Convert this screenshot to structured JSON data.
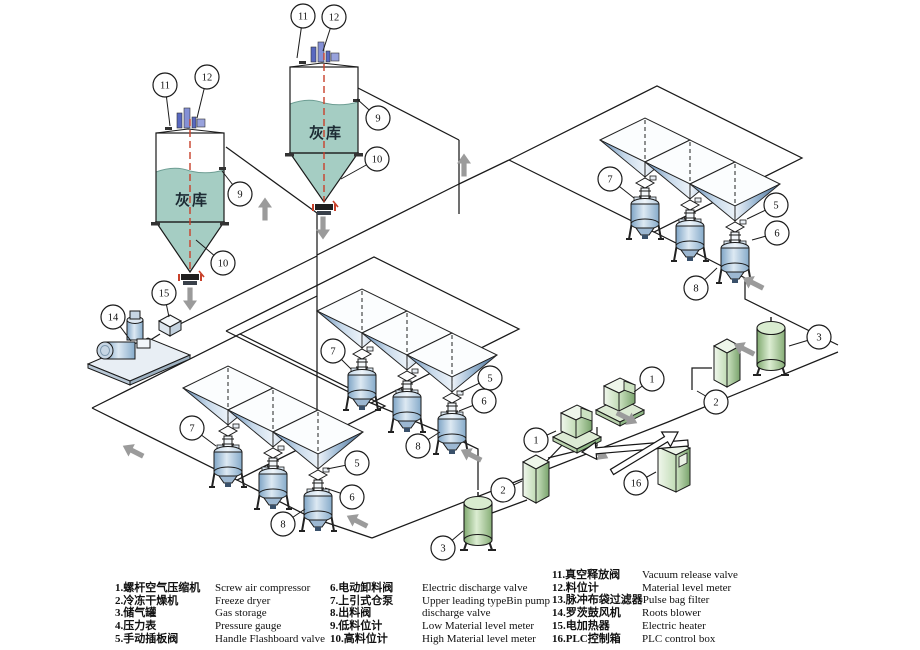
{
  "title": "Pneumatic ash conveying system diagram",
  "colors": {
    "pipe": "#1a1a1a",
    "silo_fill": "#a5cdc3",
    "silo_wave": "#6d9d93",
    "red_line": "#c8402a",
    "gray_arrow": "#9b9b9b",
    "hopper_dark": "#44698f",
    "hopper_light": "#e9f1f8",
    "green_dark": "#79a36c",
    "green_light": "#eef6ea",
    "instrument_blue": "#6375c4",
    "valve_dark": "#1f1f1f"
  },
  "silos": [
    {
      "label": "灰库",
      "x": 156,
      "y": 133,
      "w": 68,
      "h": 89,
      "tip": 272,
      "fillTop": 170,
      "labelY": 205,
      "callout_refs": [
        "11",
        "12",
        "9",
        "10"
      ]
    },
    {
      "label": "灰库",
      "x": 290,
      "y": 67,
      "w": 68,
      "h": 86,
      "tip": 202,
      "fillTop": 102,
      "labelY": 138,
      "callout_refs": [
        "11",
        "12",
        "9",
        "10"
      ]
    }
  ],
  "rows": [
    {
      "name": "hopper-row-bottom-left",
      "x": 228,
      "y": 388
    },
    {
      "name": "hopper-row-middle",
      "x": 362,
      "y": 311
    },
    {
      "name": "hopper-row-top-right",
      "x": 645,
      "y": 140
    }
  ],
  "pipes": [
    [
      [
        144,
        344
      ],
      [
        160,
        334
      ]
    ],
    [
      [
        178,
        325
      ],
      [
        317,
        256
      ]
    ],
    [
      [
        317,
        213
      ],
      [
        317,
        440
      ]
    ],
    [
      [
        226,
        147
      ],
      [
        317,
        213
      ]
    ],
    [
      [
        358,
        88
      ],
      [
        459,
        140
      ]
    ],
    [
      [
        459,
        140
      ],
      [
        459,
        214
      ]
    ],
    [
      [
        317,
        255
      ],
      [
        459,
        184
      ]
    ],
    [
      [
        459,
        184
      ],
      [
        509,
        160
      ]
    ],
    [
      [
        92,
        408
      ],
      [
        240,
        334
      ],
      [
        385,
        406
      ],
      [
        237,
        480
      ],
      [
        92,
        408
      ]
    ],
    [
      [
        226,
        331
      ],
      [
        374,
        257
      ],
      [
        519,
        329
      ],
      [
        371,
        403
      ],
      [
        226,
        331
      ]
    ],
    [
      [
        509,
        160
      ],
      [
        657,
        86
      ],
      [
        802,
        158
      ],
      [
        654,
        232
      ],
      [
        509,
        160
      ]
    ],
    [
      [
        240,
        334
      ],
      [
        317,
        296
      ]
    ],
    [
      [
        237,
        480
      ],
      [
        310,
        517
      ],
      [
        372,
        538
      ]
    ],
    [
      [
        371,
        403
      ],
      [
        455,
        438
      ],
      [
        478,
        449
      ],
      [
        478,
        490
      ]
    ],
    [
      [
        654,
        232
      ],
      [
        702,
        256
      ],
      [
        745,
        278
      ],
      [
        745,
        299
      ],
      [
        838,
        345
      ]
    ],
    [
      [
        372,
        538
      ],
      [
        668,
        422
      ],
      [
        838,
        352
      ]
    ],
    [
      [
        548,
        458
      ],
      [
        597,
        446
      ],
      [
        597,
        427
      ]
    ],
    [
      [
        527,
        500
      ],
      [
        492,
        513
      ]
    ],
    [
      [
        565,
        442
      ],
      [
        545,
        463
      ]
    ],
    [
      [
        692,
        390
      ],
      [
        692,
        368
      ],
      [
        712,
        368
      ]
    ]
  ],
  "equipment": [
    {
      "type": "blower",
      "x": 135,
      "y": 348,
      "ref": "14"
    },
    {
      "type": "heater",
      "x": 170,
      "y": 326,
      "ref": "15"
    },
    {
      "type": "compressor",
      "x": 575,
      "y": 425,
      "ref": "1"
    },
    {
      "type": "compressor",
      "x": 618,
      "y": 398,
      "ref": "1"
    },
    {
      "type": "dryer",
      "x": 536,
      "y": 482,
      "ref": "2"
    },
    {
      "type": "dryer",
      "x": 727,
      "y": 366,
      "ref": "2"
    },
    {
      "type": "tank",
      "x": 478,
      "y": 520,
      "ref": "3"
    },
    {
      "type": "tank",
      "x": 771,
      "y": 345,
      "ref": "3"
    },
    {
      "type": "plc",
      "x": 674,
      "y": 467,
      "ref": "16"
    }
  ],
  "flow_arrows": [
    {
      "x": 190,
      "y": 299,
      "dir": "down"
    },
    {
      "x": 323,
      "y": 228,
      "dir": "down"
    },
    {
      "x": 265,
      "y": 209,
      "dir": "up"
    },
    {
      "x": 464,
      "y": 165,
      "dir": "up"
    },
    {
      "x": 133,
      "y": 451,
      "dir": "upleft"
    },
    {
      "x": 357,
      "y": 521,
      "dir": "upleft"
    },
    {
      "x": 471,
      "y": 455,
      "dir": "upleft"
    },
    {
      "x": 753,
      "y": 283,
      "dir": "upleft"
    },
    {
      "x": 744,
      "y": 349,
      "dir": "upleft"
    },
    {
      "x": 598,
      "y": 453,
      "dir": "downright"
    },
    {
      "x": 627,
      "y": 418,
      "dir": "downright"
    }
  ],
  "signal_arrows": [
    {
      "x1": 688,
      "y1": 443,
      "x2": 582,
      "y2": 452
    },
    {
      "x1": 612,
      "y1": 472,
      "x2": 678,
      "y2": 432
    }
  ],
  "callouts": [
    {
      "n": "11",
      "x": 165,
      "y": 85,
      "tx": 170,
      "ty": 126
    },
    {
      "n": "12",
      "x": 207,
      "y": 77,
      "tx": 197,
      "ty": 118
    },
    {
      "n": "9",
      "x": 240,
      "y": 194,
      "tx": 222,
      "ty": 171
    },
    {
      "n": "10",
      "x": 223,
      "y": 263,
      "tx": 196,
      "ty": 240
    },
    {
      "n": "15",
      "x": 164,
      "y": 293,
      "tx": 169,
      "ty": 317
    },
    {
      "n": "14",
      "x": 113,
      "y": 317,
      "tx": 131,
      "ty": 341
    },
    {
      "n": "11",
      "x": 303,
      "y": 16,
      "tx": 297,
      "ty": 58
    },
    {
      "n": "12",
      "x": 334,
      "y": 17,
      "tx": 323,
      "ty": 51
    },
    {
      "n": "9",
      "x": 378,
      "y": 118,
      "tx": 357,
      "ty": 99
    },
    {
      "n": "10",
      "x": 377,
      "y": 159,
      "tx": 341,
      "ty": 179
    },
    {
      "n": "7",
      "x": 192,
      "y": 428,
      "tx": 216,
      "ty": 446
    },
    {
      "n": "5",
      "x": 357,
      "y": 463,
      "tx": 327,
      "ty": 469
    },
    {
      "n": "6",
      "x": 352,
      "y": 497,
      "tx": 325,
      "ty": 488
    },
    {
      "n": "8",
      "x": 283,
      "y": 524,
      "tx": 305,
      "ty": 509
    },
    {
      "n": "7",
      "x": 333,
      "y": 351,
      "tx": 351,
      "ty": 369
    },
    {
      "n": "5",
      "x": 490,
      "y": 378,
      "tx": 461,
      "ty": 392
    },
    {
      "n": "6",
      "x": 484,
      "y": 401,
      "tx": 459,
      "ty": 411
    },
    {
      "n": "8",
      "x": 418,
      "y": 446,
      "tx": 440,
      "ty": 432
    },
    {
      "n": "7",
      "x": 610,
      "y": 179,
      "tx": 634,
      "ty": 198
    },
    {
      "n": "5",
      "x": 776,
      "y": 205,
      "tx": 747,
      "ty": 219
    },
    {
      "n": "6",
      "x": 777,
      "y": 233,
      "tx": 752,
      "ty": 240
    },
    {
      "n": "8",
      "x": 696,
      "y": 288,
      "tx": 717,
      "ty": 268
    },
    {
      "n": "1",
      "x": 536,
      "y": 440,
      "tx": 556,
      "ty": 431
    },
    {
      "n": "1",
      "x": 652,
      "y": 379,
      "tx": 634,
      "ty": 392
    },
    {
      "n": "2",
      "x": 503,
      "y": 490,
      "tx": 522,
      "ty": 481
    },
    {
      "n": "2",
      "x": 716,
      "y": 402,
      "tx": 697,
      "ty": 391
    },
    {
      "n": "3",
      "x": 443,
      "y": 548,
      "tx": 463,
      "ty": 531
    },
    {
      "n": "3",
      "x": 819,
      "y": 337,
      "tx": 789,
      "ty": 346
    },
    {
      "n": "16",
      "x": 636,
      "y": 483,
      "tx": 656,
      "ty": 472
    }
  ],
  "legend": {
    "columns": [
      {
        "x": 115,
        "y": 582,
        "zhw": 100,
        "items": [
          {
            "zh": "1.螺杆空气压缩机",
            "en": "Screw air compressor"
          },
          {
            "zh": "2.冷冻干燥机",
            "en": "Freeze dryer"
          },
          {
            "zh": "3.储气罐",
            "en": "Gas storage"
          },
          {
            "zh": "4.压力表",
            "en": "Pressure gauge"
          },
          {
            "zh": "5.手动插板阀",
            "en": "Handle Flashboard valve"
          }
        ]
      },
      {
        "x": 330,
        "y": 582,
        "zhw": 92,
        "items": [
          {
            "zh": "6.电动卸料阀",
            "en": "Electric discharge valve"
          },
          {
            "zh": "7.上引式仓泵",
            "en": "Upper leading typeBin pump"
          },
          {
            "zh": "8.出料阀",
            "en": "discharge valve"
          },
          {
            "zh": "9.低料位计",
            "en": "Low Material level meter"
          },
          {
            "zh": "10.高料位计",
            "en": "High Material level meter"
          }
        ]
      },
      {
        "x": 552,
        "y": 569,
        "zhw": 90,
        "items": [
          {
            "zh": "11.真空释放阀",
            "en": "Vacuum release valve"
          },
          {
            "zh": "12.料位计",
            "en": "Material level meter"
          },
          {
            "zh": "13.脉冲布袋过滤器",
            "en": "Pulse bag filter"
          },
          {
            "zh": "14.罗茨鼓风机",
            "en": "Roots blower"
          },
          {
            "zh": "15.电加热器",
            "en": "Electric heater"
          },
          {
            "zh": "16.PLC控制箱",
            "en": "PLC control box"
          }
        ]
      }
    ]
  }
}
